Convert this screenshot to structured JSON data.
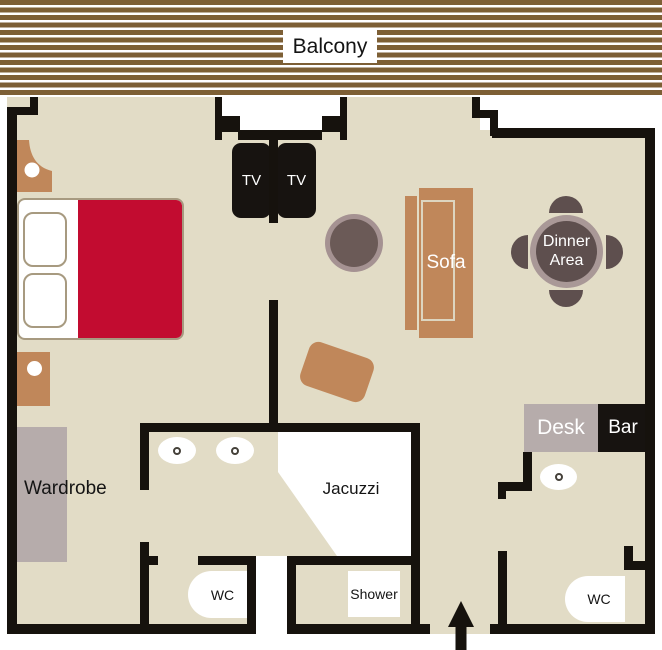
{
  "floorplan": {
    "labels": {
      "balcony": "Balcony",
      "tv": "TV",
      "sofa": "Sofa",
      "dinner_line1": "Dinner",
      "dinner_line2": "Area",
      "wardrobe": "Wardrobe",
      "jacuzzi": "Jacuzzi",
      "wc": "WC",
      "shower": "Shower",
      "desk": "Desk",
      "bar": "Bar"
    },
    "colors": {
      "floor": "#e2dcc6",
      "wall": "#16120d",
      "balcony_stripe": "#7d5f35",
      "bed_red": "#c20c30",
      "wood_furniture": "#c0875a",
      "wardrobe_grey": "#b6acab",
      "dinner_table_dark": "#5e4f4e",
      "dinner_table_ring": "#a99897",
      "pouf_outer": "#a59292",
      "pouf_inner": "#6b5a57"
    }
  }
}
